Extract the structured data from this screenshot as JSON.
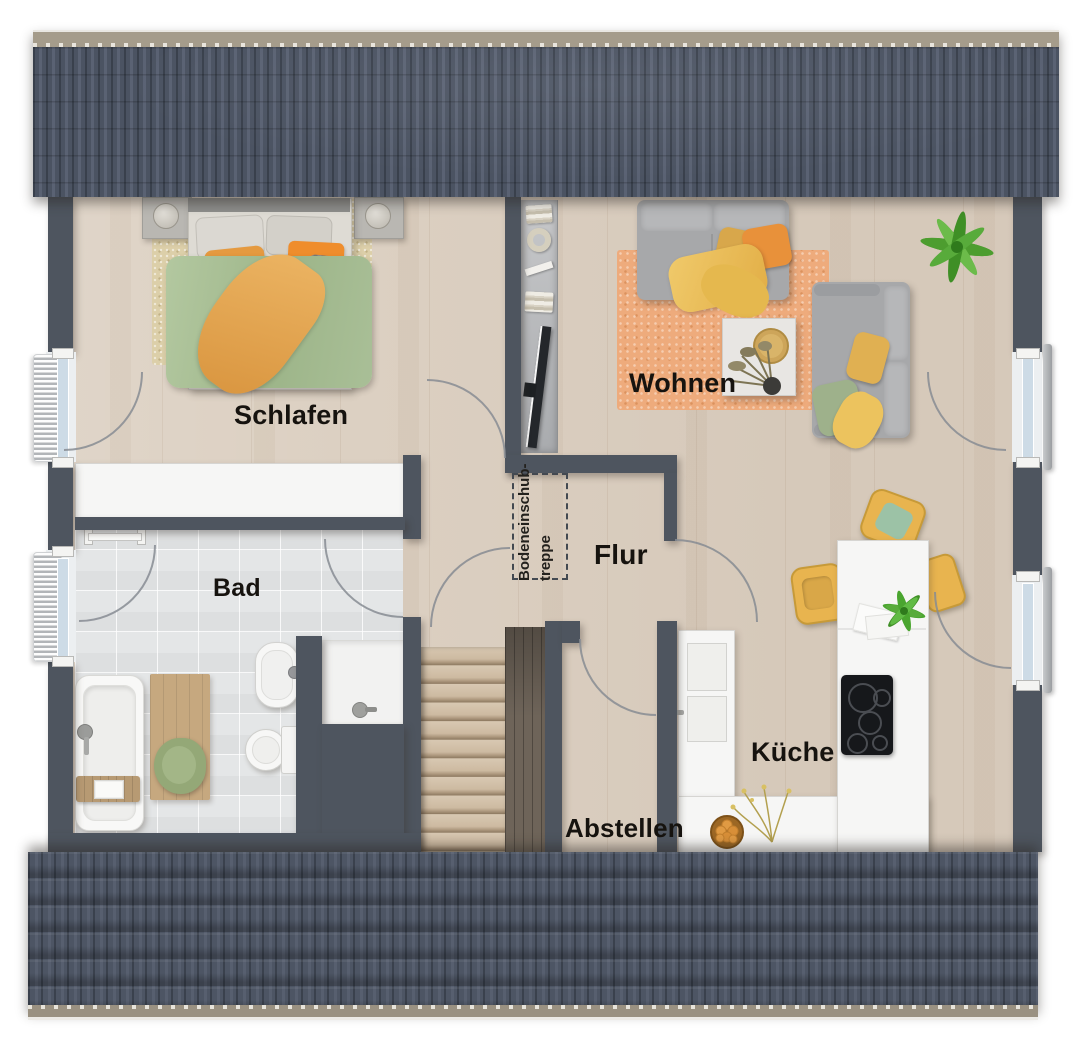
{
  "floorplan": {
    "rooms": {
      "schlafen": {
        "label": "Schlafen"
      },
      "wohnen": {
        "label": "Wohnen"
      },
      "bad": {
        "label": "Bad"
      },
      "flur": {
        "label": "Flur"
      },
      "kueche": {
        "label": "Küche"
      },
      "abstellen": {
        "label": "Abstellen"
      }
    },
    "annotations": {
      "attic_hatch": {
        "line1": "Bodeneinschub-",
        "line2": "treppe"
      }
    },
    "colors": {
      "roof": "#48505d",
      "roof_ridge": "#a59c8b",
      "roof_eave": "#9a9181",
      "wall": "#4e555f",
      "wood_floor": "#dcd0c2",
      "tile_floor": "#e4e6e7",
      "stair_wood": "#c9b69d",
      "rug_living": "#eeab7c",
      "rug_bedroom": "#dccfa9",
      "sofa_gray": "#a7a8aa",
      "duvet_green": "#a5bc92",
      "accent_orange": "#e8913a",
      "accent_yellow": "#e8b44f",
      "plant_green": "#55a637",
      "window_glass": "#cddbe6"
    },
    "furniture": {
      "schlafen": [
        "double-bed",
        "nightstand-left",
        "nightstand-right",
        "bedside-lamps",
        "area-rug",
        "wardrobe"
      ],
      "wohnen": [
        "sofa",
        "lounge-sofa",
        "coffee-table",
        "decor-tray",
        "dried-plant",
        "area-rug",
        "palm-plant",
        "shelf-unit-with-tv"
      ],
      "bad": [
        "bathtub",
        "bath-caddy",
        "bath-mat",
        "towel",
        "washbasin",
        "toilet",
        "shower",
        "towel-rail"
      ],
      "kueche": [
        "kitchen-island",
        "cooktop",
        "bar-chairs",
        "tall-cabinet",
        "counter",
        "fruit-bowl",
        "flower-branch",
        "potted-plant"
      ],
      "flur": [
        "attic-hatch-outline"
      ],
      "treppe": [
        "staircase"
      ]
    }
  }
}
